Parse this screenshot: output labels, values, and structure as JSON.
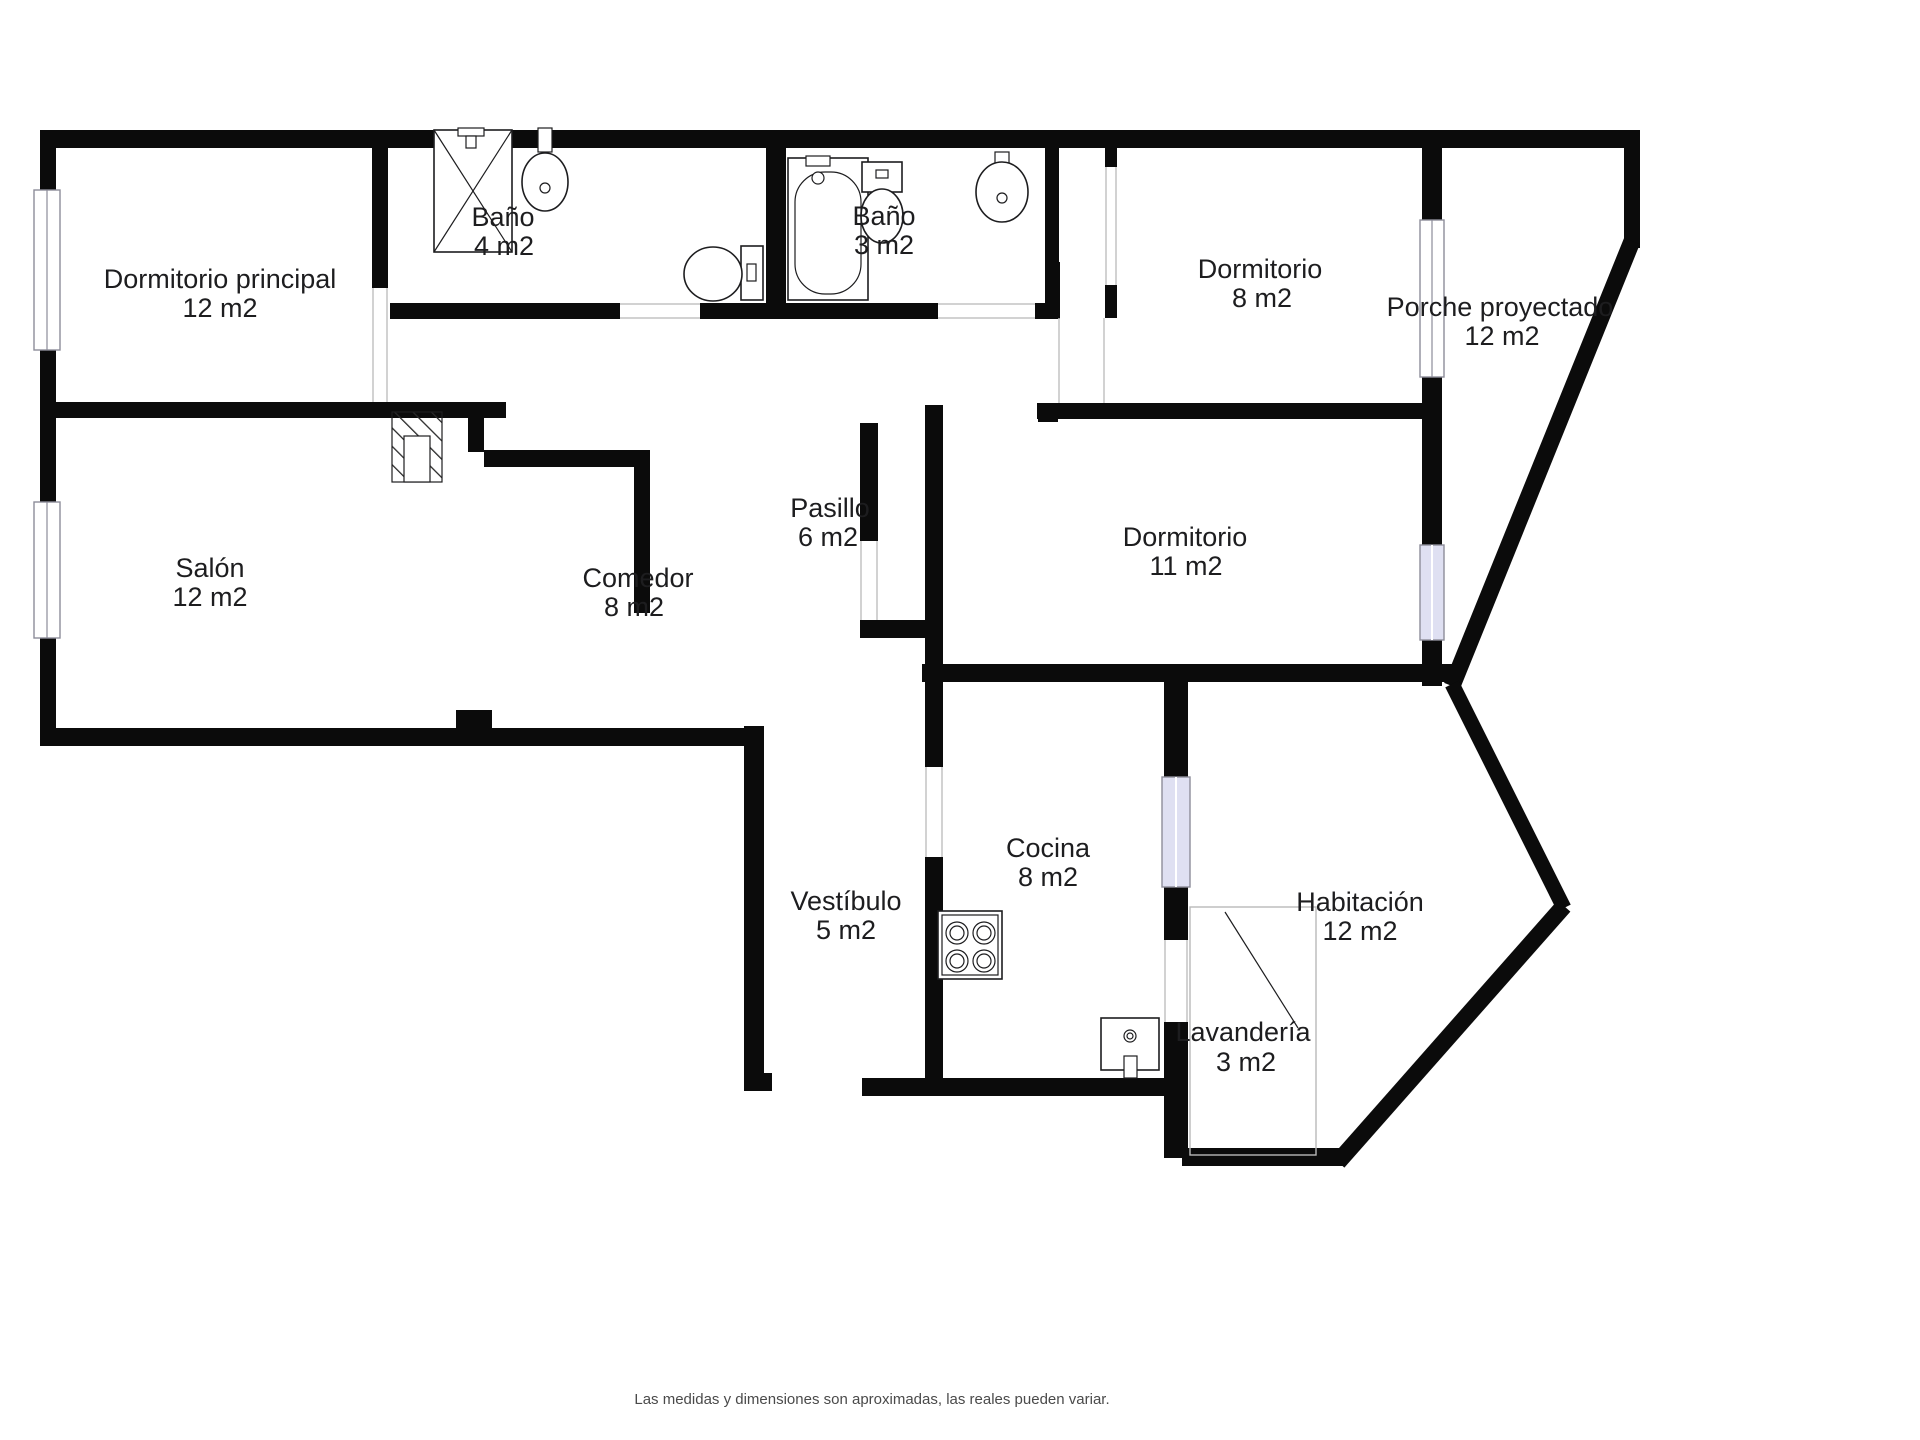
{
  "plan_title": "Floor plan",
  "footer": {
    "disclaimer": "Las medidas y dimensiones son aproximadas, las reales pueden variar."
  },
  "colors": {
    "wall": "#0b0b0b",
    "window_tint": "#dfe0f2",
    "door_line": "#c4c4c4",
    "label_text": "#1d1d1f",
    "footer_text": "#4a4a4a",
    "background": "#ffffff"
  },
  "rooms": {
    "dormitorio_principal": {
      "name": "Dormitorio principal",
      "area": "12 m2"
    },
    "bano_4": {
      "name": "Baño",
      "area": "4 m2"
    },
    "bano_3": {
      "name": "Baño",
      "area": "3 m2"
    },
    "dormitorio_8": {
      "name": "Dormitorio",
      "area": "8 m2"
    },
    "porche": {
      "name": "Porche proyectado",
      "area": "12 m2"
    },
    "salon": {
      "name": "Salón",
      "area": "12 m2"
    },
    "comedor": {
      "name": "Comedor",
      "area": "8 m2"
    },
    "pasillo": {
      "name": "Pasillo",
      "area": "6 m2"
    },
    "dormitorio_11": {
      "name": "Dormitorio",
      "area": "11 m2"
    },
    "vestibulo": {
      "name": "Vestíbulo",
      "area": "5 m2"
    },
    "cocina": {
      "name": "Cocina",
      "area": "8 m2"
    },
    "habitacion": {
      "name": "Habitación",
      "area": "12 m2"
    },
    "lavanderia": {
      "name": "Lavandería",
      "area": "3 m2"
    }
  },
  "fixtures": {
    "shower": "shower-icon",
    "bathroom_sink_1": "sink-icon",
    "toilet_1": "toilet-icon",
    "bathtub": "bathtub-icon",
    "toilet_2": "toilet-icon",
    "bathroom_sink_2": "sink-icon",
    "stove": "stove-icon",
    "kitchen_sink": "kitchen-sink-icon",
    "chimney": "chimney-hatch-icon"
  }
}
